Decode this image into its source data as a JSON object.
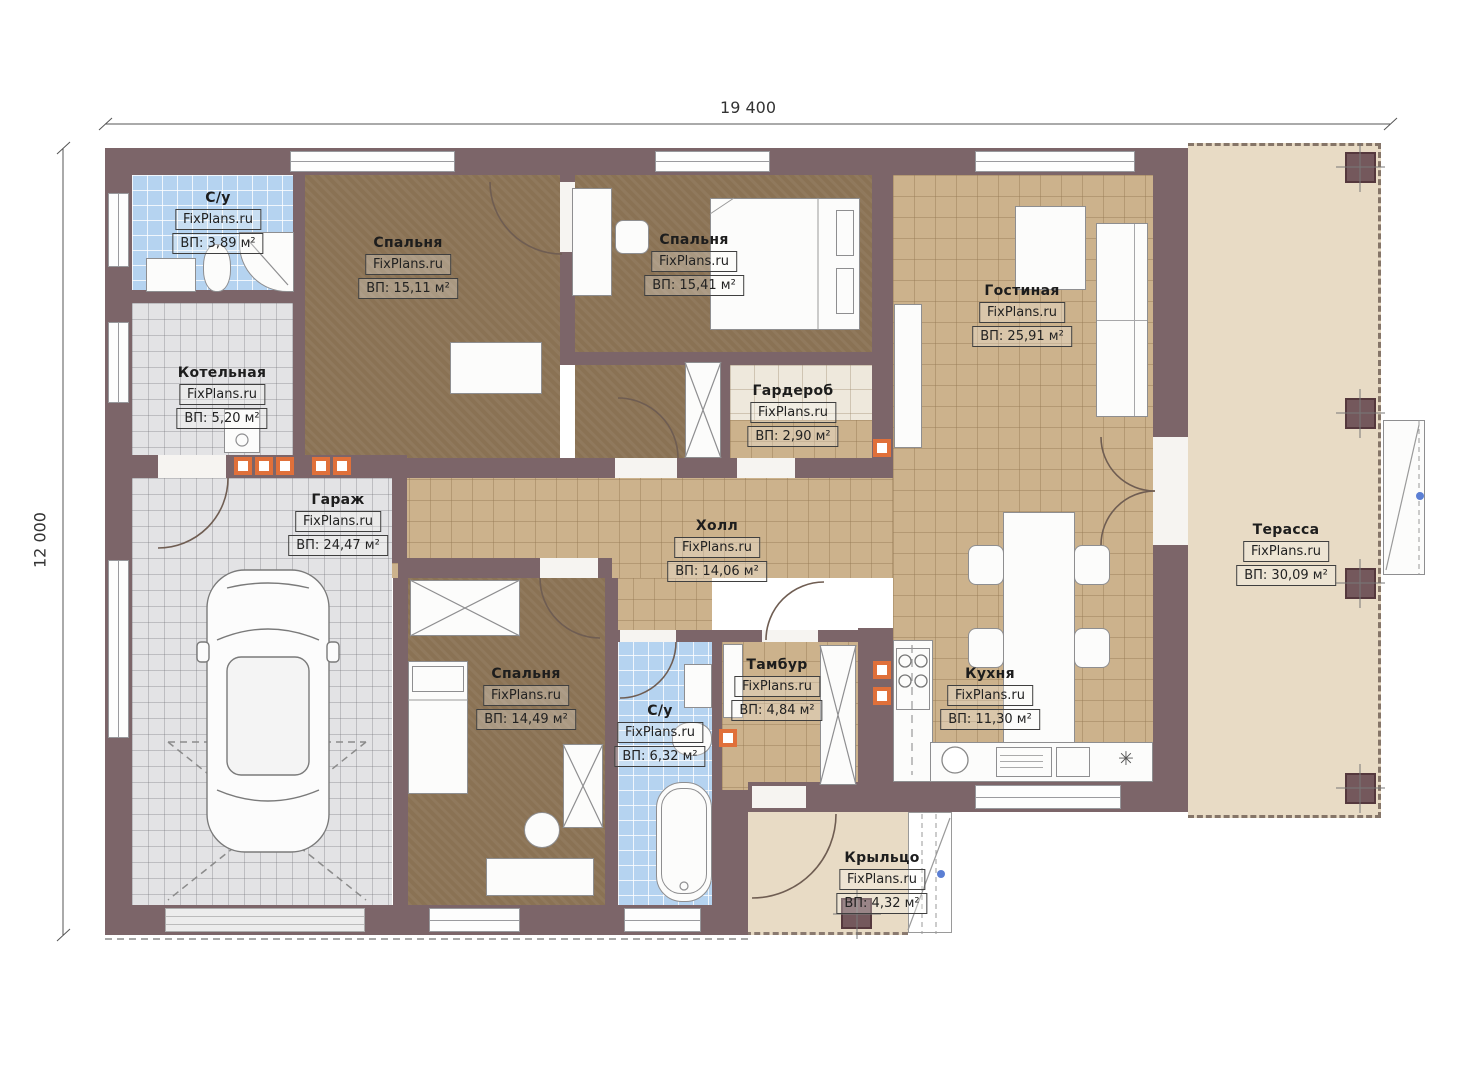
{
  "dimensions": {
    "width_label": "19 400",
    "height_label": "12 000"
  },
  "brand": "FixPlans.ru",
  "rooms": [
    {
      "id": "su1",
      "name": "С/у",
      "area": "ВП: 3,89 м²"
    },
    {
      "id": "boiler",
      "name": "Котельная",
      "area": "ВП: 5,20 м²"
    },
    {
      "id": "bedroom1",
      "name": "Спальня",
      "area": "ВП: 15,11 м²"
    },
    {
      "id": "bedroom2",
      "name": "Спальня",
      "area": "ВП: 15,41 м²"
    },
    {
      "id": "wardrobe",
      "name": "Гардероб",
      "area": "ВП: 2,90 м²"
    },
    {
      "id": "living",
      "name": "Гостиная",
      "area": "ВП: 25,91 м²"
    },
    {
      "id": "garage",
      "name": "Гараж",
      "area": "ВП: 24,47 м²"
    },
    {
      "id": "hall",
      "name": "Холл",
      "area": "ВП: 14,06 м²"
    },
    {
      "id": "bedroom3",
      "name": "Спальня",
      "area": "ВП: 14,49 м²"
    },
    {
      "id": "su2",
      "name": "С/у",
      "area": "ВП: 6,32 м²"
    },
    {
      "id": "tambour",
      "name": "Тамбур",
      "area": "ВП: 4,84 м²"
    },
    {
      "id": "kitchen",
      "name": "Кухня",
      "area": "ВП: 11,30 м²"
    },
    {
      "id": "terrace",
      "name": "Терасса",
      "area": "ВП: 30,09 м²"
    },
    {
      "id": "porch",
      "name": "Крыльцо",
      "area": "ВП: 4,32 м²"
    }
  ],
  "symbols": {
    "defrost": "✳"
  },
  "colors": {
    "wall": "#7c6569",
    "tile_beige": "#ccb28c",
    "tile_gray": "#e3e3e5",
    "tile_blue": "#b5d3f0",
    "floor_brown": "#8a7254",
    "outdoor_beige": "#e8dbc5",
    "vent_orange": "#e0703a",
    "marker_blue": "#5b7fd4"
  }
}
